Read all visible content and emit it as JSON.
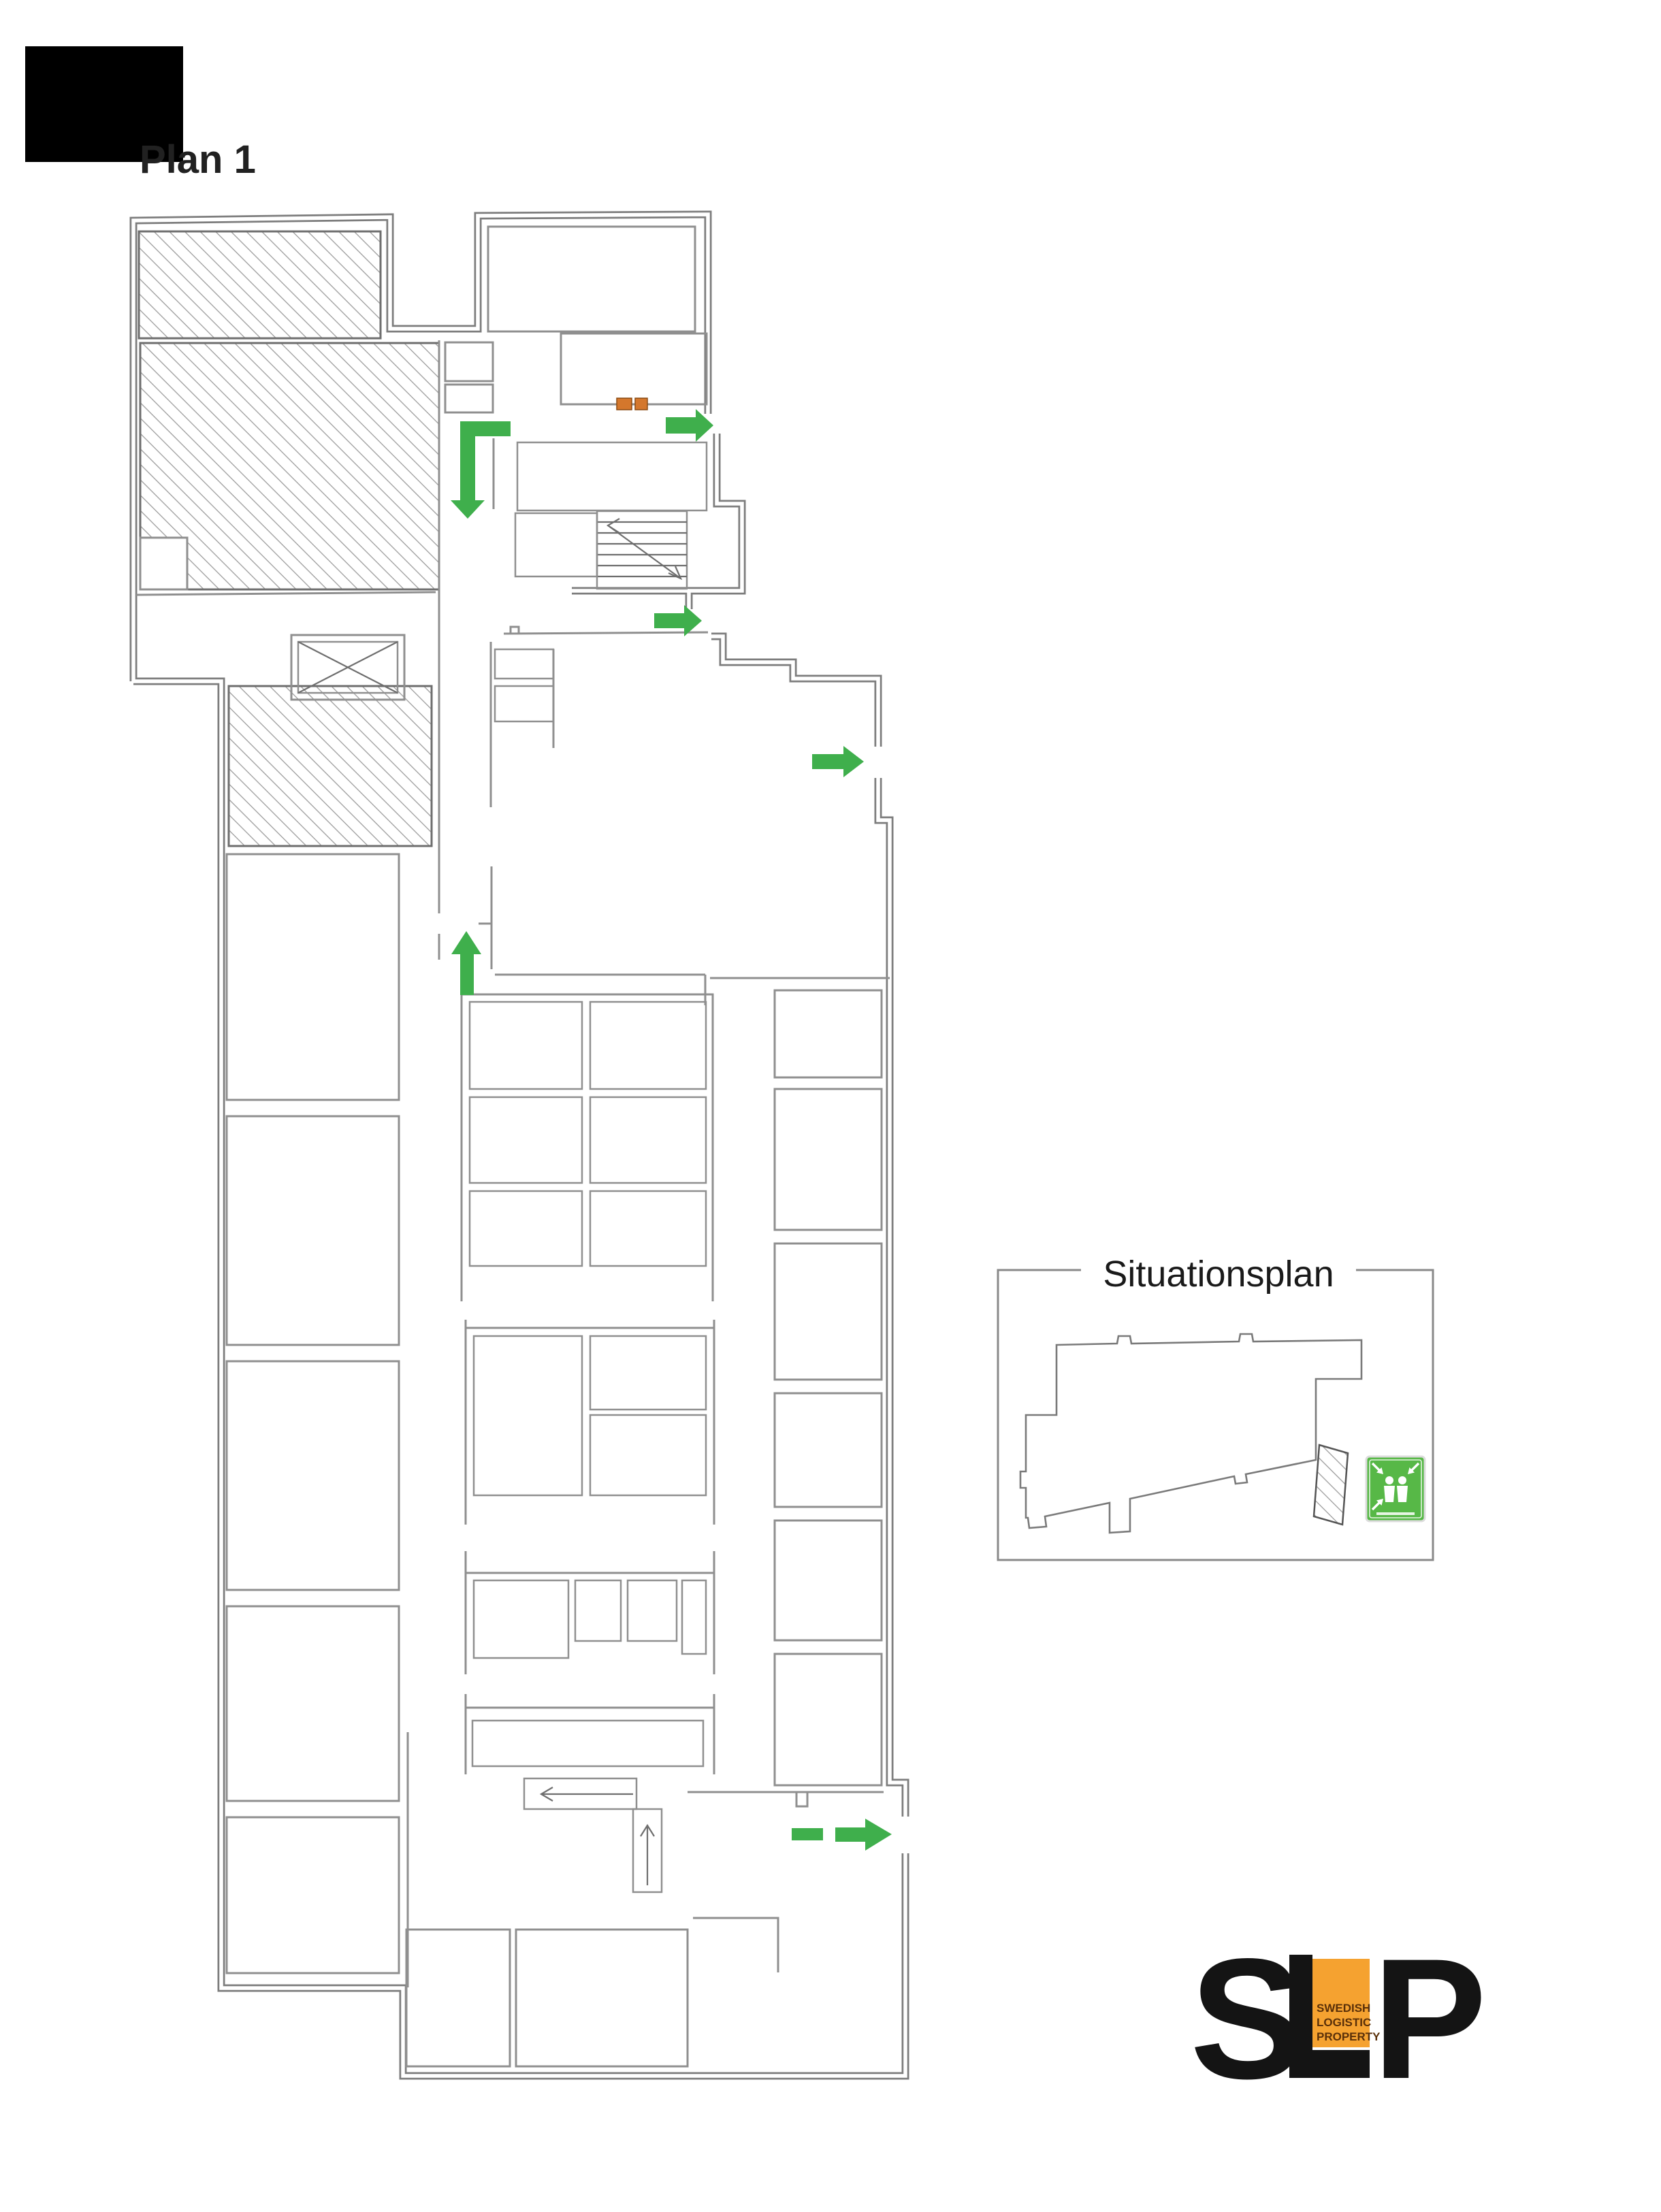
{
  "plan": {
    "title": "Plan 1"
  },
  "situationsplan": {
    "label": "Situationsplan"
  },
  "logo": {
    "letters": "SLP",
    "letter_s": "S",
    "letter_p": "P",
    "subtext_lines": [
      "SWEDISH",
      "LOGISTIC",
      "PROPERTY"
    ],
    "orange": "#F5A230",
    "black": "#141414"
  },
  "colors": {
    "background": "#ffffff",
    "wall_gray": "#7d7d7d",
    "room_gray": "#8f8f8f",
    "hatch_gray": "#9c9c9c",
    "escape_green": "#3FAF4C",
    "door_marker_orange": "#D4772C",
    "door_marker_edge": "#8a4a12",
    "assembly_green": "#57B847",
    "redaction_black": "#000000",
    "title_text": "#212121"
  },
  "icons": {
    "elevator": "elevator-x-icon",
    "stairs": "stairs-icon",
    "escape_arrow": "escape-route-arrow-icon",
    "assembly_point": "assembly-point-icon",
    "door_marker": "fire-door-marker-icon"
  }
}
